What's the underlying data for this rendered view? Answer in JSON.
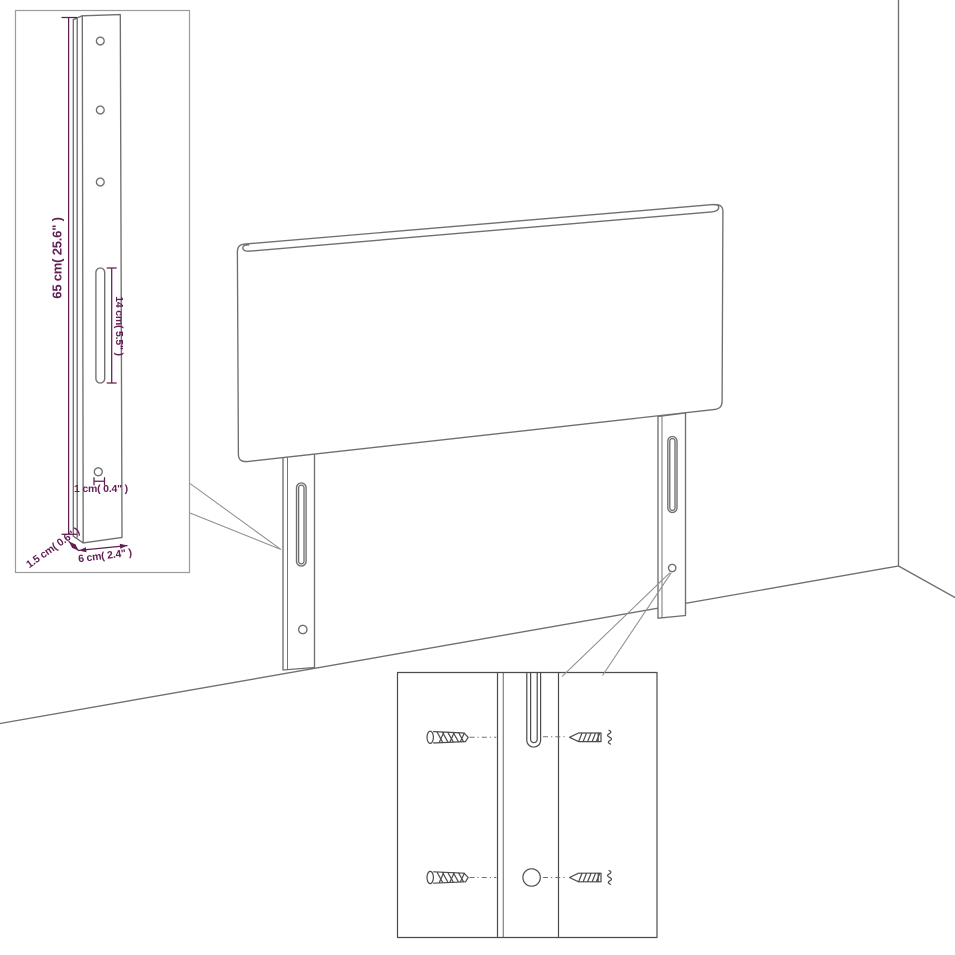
{
  "colors": {
    "line_gray": "#6f6f6f",
    "dark_gray": "#4b4b4b",
    "leader_gray": "#8f8f8f",
    "box_border_gray": "#9c9c9c",
    "dimension_purple": "#5f1f53",
    "background": "#ffffff"
  },
  "dimension_labels": {
    "post_height": "65 cm( 25.6\" )",
    "slot_length": "14 cm( 5.5\" )",
    "hole_diameter": "1 cm( 0.4\" )",
    "post_thickness": "1.5 cm( 0.6\" )",
    "post_width": "6 cm( 2.4\" )"
  },
  "icons": {
    "wall_plug": "wall-plug-anchor-icon",
    "screw": "screw-icon"
  }
}
